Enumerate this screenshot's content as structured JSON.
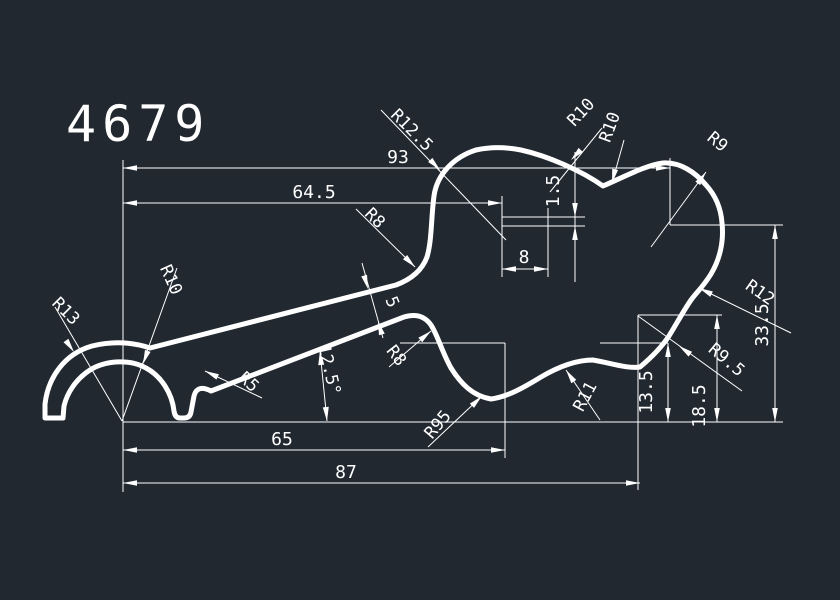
{
  "title": "4679",
  "colors": {
    "background": "#212830",
    "line": "#ffffff"
  },
  "dimensions": {
    "d93": "93",
    "d64_5": "64.5",
    "d8": "8",
    "d1_5": "1.5",
    "d65": "65",
    "d87": "87",
    "d13_5": "13.5",
    "d18_5": "18.5",
    "d33_5": "33.5",
    "angle": "12.5°",
    "thickness": "5"
  },
  "radii": {
    "r13": "R13",
    "r10_left": "R10",
    "r5": "R5",
    "r8_upper": "R8",
    "r8_lower": "R8",
    "r12_5": "R12.5",
    "r95": "R95",
    "r10_top1": "R10",
    "r10_top2": "R10",
    "r9": "R9",
    "r12": "R12",
    "r9_5": "R9.5",
    "r11": "R11"
  }
}
